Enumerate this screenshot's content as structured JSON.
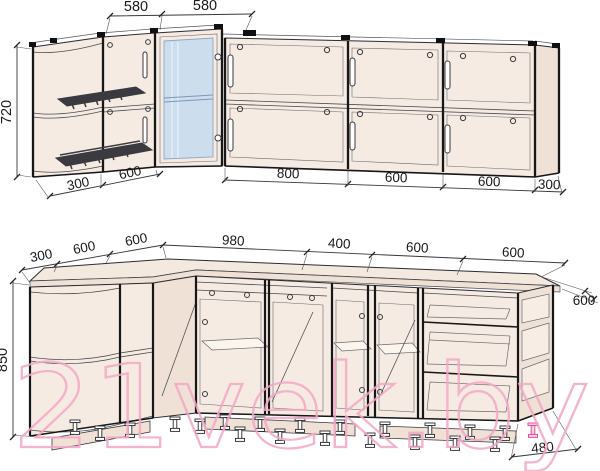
{
  "title": "kitchen-cabinet-dimension-drawing",
  "watermark": {
    "text": "21vek.by",
    "color": "#f3a7c6"
  },
  "colors": {
    "line_dark": "#1b1b1e",
    "line_mid": "#3a3a3e",
    "line_thin": "#55555c",
    "panel_fill": "#f6ebe2",
    "panel_fill_alt": "#efe1d5",
    "countertop_fill": "#f4e9de",
    "glass_fill": "#ccdeee",
    "glass_line": "#7e98ba",
    "rack_dark": "#3a3a40",
    "leg_pink": "#e2509d",
    "dim_text": "#19191c"
  },
  "upper_drawing": {
    "name": "wall-cabinets-elevation",
    "height_dim": "720",
    "top_dims": [
      "580",
      "580"
    ],
    "bottom_left_dims": [
      "300",
      "600"
    ],
    "bottom_right_dims": [
      "800",
      "600",
      "600",
      "300"
    ]
  },
  "lower_drawing": {
    "name": "base-cabinets-elevation",
    "height_dim": "850",
    "top_dims": [
      "300",
      "600",
      "600",
      "980",
      "400",
      "600",
      "600"
    ],
    "depth_dim": "600",
    "bottom_depth_dim": "480"
  }
}
